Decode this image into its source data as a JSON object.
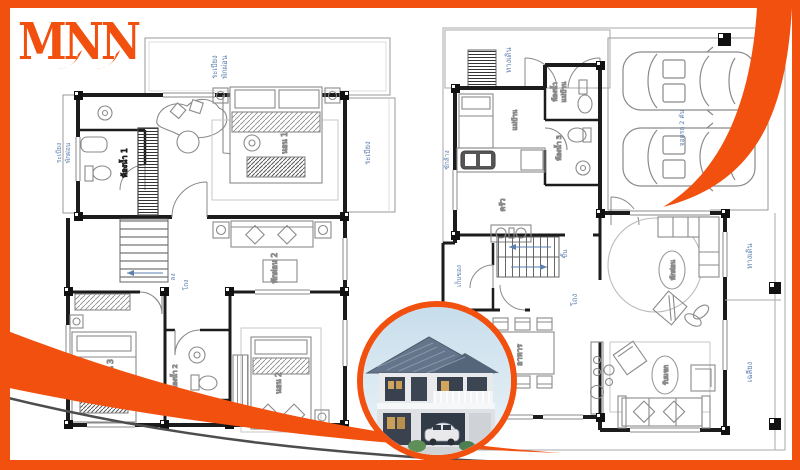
{
  "logo": {
    "text": "MNN"
  },
  "colors": {
    "accent": "#F2500F",
    "label_blue": "#5B7FAF",
    "wall": "#1c1c1c",
    "furniture_line": "#8a8a8a",
    "roof": "#64748a"
  },
  "plan_left": {
    "name": "second-floor-plan",
    "labels": {
      "terrace_1": "ระเบียง",
      "terrace_2": "พักผ่อน",
      "balcony_left_1": "ระเบียง",
      "balcony_left_2": "พักผ่อน",
      "bath1": "ห้องน้ำ 1",
      "bed1": "นอน 1",
      "balcony_right": "ระเบียง",
      "lounge2": "พักผ่อน 2",
      "down": "ลง",
      "hall": "โถง",
      "bed3": "นอน 3",
      "bath2": "ห้องน้ำ 2",
      "bed2": "นอน 2"
    }
  },
  "plan_right": {
    "name": "first-floor-plan",
    "labels": {
      "walkway_top": "ทางเดิน",
      "maid": "แม่บ้าน",
      "maid_bath_1": "ห้องน้ำ",
      "maid_bath_2": "แม่บ้าน",
      "bath3": "ห้องน้ำ 3",
      "laundry": "ซักล้าง",
      "kitchen": "ครัว",
      "storage": "เก็บของ",
      "up": "ขึ้น",
      "hall": "โถง",
      "dining": "อาหาร",
      "lounge": "พักผ่อน",
      "living": "รับแขก",
      "walkway_right": "ทางเดิน",
      "porch": "เฉลียง",
      "carpark": "จอดรถ 2 คัน"
    }
  },
  "inset": {
    "description": "two-storey house photo"
  }
}
